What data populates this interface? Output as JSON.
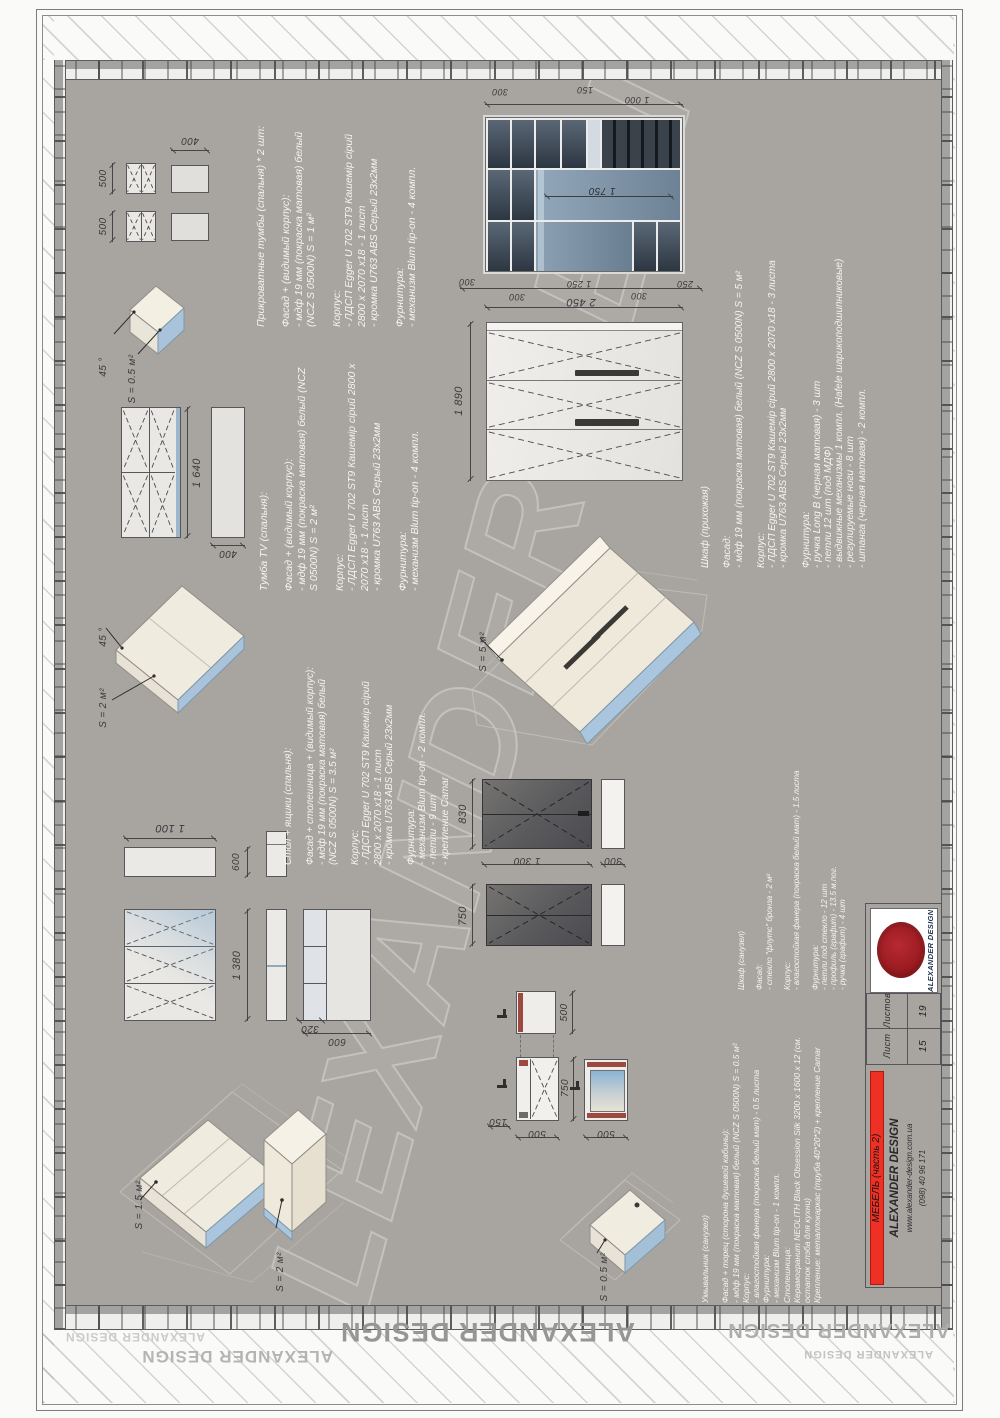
{
  "sheet": {
    "bg": "#a8a5a1",
    "accent_red": "#ee3124"
  },
  "watermark": {
    "text": "ALEXANDER DESIGN"
  },
  "blocks": {
    "bedside": {
      "title": "Прикроватные тумбы (спальня) * 2 шт:",
      "lines": [
        "Фасад + (видимый корпус):",
        "- мдф 19 мм (покраска матовая) белый",
        "(NCZ S 0500N) S = 1 м²",
        "",
        "Корпус:",
        "- ЛДСП Egger U 702 ST9 Кашемір сірий",
        "2800 х 2070 х18 - 1 лист",
        "- кромка U763 ABS Серый 23х2мм",
        "",
        "Фурнитура:",
        "- механизм Blum tip-on - 4 компл."
      ]
    },
    "tv": {
      "title": "Тумба TV (спальня):",
      "lines": [
        "Фасад + (видимый корпус):",
        "- мдф 19 мм (покраска матовая) белый (NCZ",
        "S 0500N) S = 2 м²",
        "",
        "Корпус:",
        "- ЛДСП Egger U 702 ST9 Кашемір сірий 2800 х",
        "2070 х18 - 1 лист",
        "- кромка U763 ABS Серый 23х2мм",
        "",
        "Фурнитура:",
        "- механизм Blum tip-on - 4 компл."
      ]
    },
    "desk": {
      "title": "Стол + ящики (спальня):",
      "lines": [
        "Фасад + столешница + (видимый корпус):",
        "- мдф 19 мм (покраска матовая) белый",
        "(NCZ S 0500N) S = 3.5 м²",
        "",
        "Корпус:",
        "- ЛДСП Egger U 702 ST9 Кашемір сірий",
        "2800 х 2070 х18 - 1 лист",
        "- кромка U763 ABS Серый 23х2мм",
        "",
        "Фурнитура:",
        "- механизм Blum tip-on - 2 компл.",
        "- петли - 9 шт",
        "- крепление Camar"
      ]
    },
    "hall": {
      "title": "Шкаф (прихожая)",
      "lines": [
        "Фасад:",
        "- мдф 19 мм (покраска матовая) белый (NCZ S 0500N) S = 5 м²",
        "",
        "Корпус:",
        "- ЛДСП Egger U 702 ST9 Кашемір сірий 2800 х 2070 х18 - 3 листа",
        "- кромка U763 ABS Серый 23х2мм",
        "",
        "Фурнитура:",
        "- ручка Long B (черная матовая) - 3 шт",
        "- петли 12 шт (под МДФ)",
        "- выдвижные механизмы 1 компл. (Hafele шарикоподшипниковые)",
        "- регулируемые ноги - 8 шт",
        "- штанга (черная матовая) - 2 компл."
      ]
    },
    "bath": {
      "title": "Шкаф (санузел)",
      "lines": [
        "Фасад:",
        "- стекло \"флутс\" бронза - 2 м²",
        "",
        "Корпус:",
        "- влагостойкая фанера (покраска белый мат) - 1.5 листа",
        "",
        "Фурнитура:",
        "- петли под стекло - 12 шт",
        "- профиль (графит) - 13.5 м.пог.",
        "- ручка (графит) - 4 шт"
      ]
    },
    "basin": {
      "title": "Умывальник (санузел)",
      "lines": [
        "Фасад + торец (сторона душевой кабины):",
        "- мдф 19 мм (покраска матовая) белый (NCZ S 0500N) S = 0.5 м²",
        "Корпус:",
        "- влагостойкая фанера (покраска белый мат) - 0.5 листа",
        "Фурнитура:",
        "- механизм Blum tip-on - 1 компл.",
        "Столешница:",
        "Керамогранит NEOLITH Black Obsession Silk 3200 x 1600 x 12 (см.",
        "остаток слэба для кухни)",
        "Крепление: металлокаркас (труба 40*20*2) + крепление Camar"
      ]
    }
  },
  "labels": {
    "deg45": "45 °",
    "s05": "S = 0.5 м²",
    "s15": "S = 1.5 м²",
    "s2": "S = 2 м²",
    "s5": "S = 5 м²"
  },
  "dims": {
    "d150": "150",
    "d250": "250",
    "d300": "300",
    "d320": "320",
    "d400": "400",
    "d500": "500",
    "d600": "600",
    "d750": "750",
    "d830": "830",
    "d1000": "1 000",
    "d1100": "1 100",
    "d1250": "1 250",
    "d1300": "1 300",
    "d1380": "1 380",
    "d1640": "1 640",
    "d1750": "1 750",
    "d1890": "1 890",
    "d2450": "2 450"
  },
  "title_block": {
    "project": "МЕБЕЛЬ (часть 2)",
    "company": "ALEXANDER DESIGN",
    "website": "www.alexander-design.com.ua",
    "phone": "(098) 40 96 171",
    "sheet_label": "Лист",
    "sheets_label": "Листов",
    "sheet_number": "15",
    "sheets_total": "19",
    "stamp_text": "ALEXANDER DESIGN"
  }
}
